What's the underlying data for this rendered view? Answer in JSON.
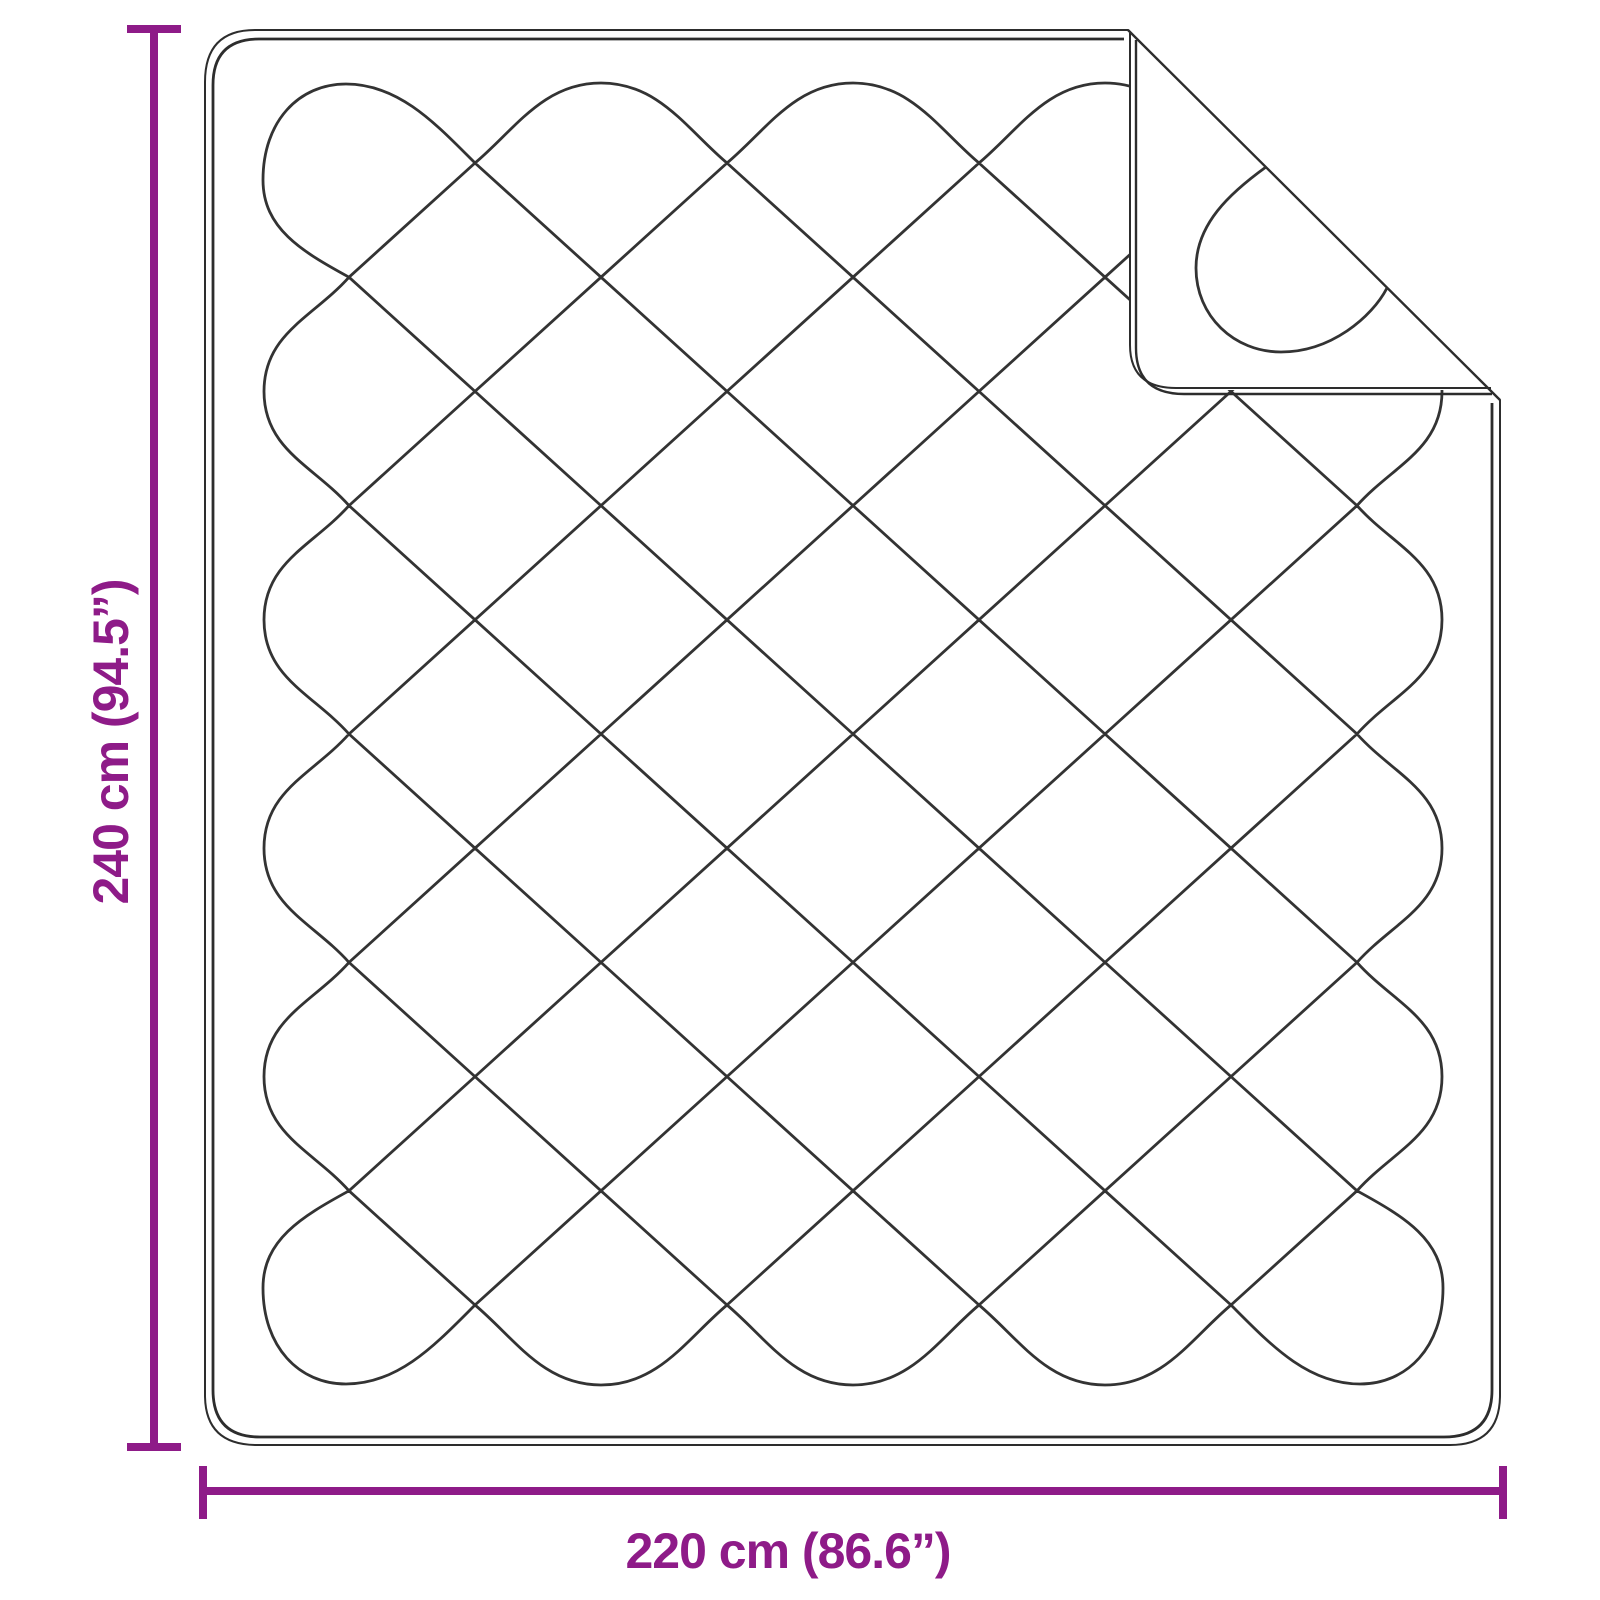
{
  "diagram": {
    "type": "product-dimension-diagram",
    "subject": "quilted-blanket-top-view-with-folded-corner",
    "height_dimension": {
      "label": "240 cm (94.5”)",
      "value_cm": 240,
      "value_inch": 94.5
    },
    "width_dimension": {
      "label": "220 cm (86.6”)",
      "value_cm": 220,
      "value_inch": 86.6
    },
    "colors": {
      "dimension_accent": "#8E1B88",
      "outline": "#2d2d2d",
      "quilt_line": "#333333",
      "background": "#ffffff"
    }
  }
}
